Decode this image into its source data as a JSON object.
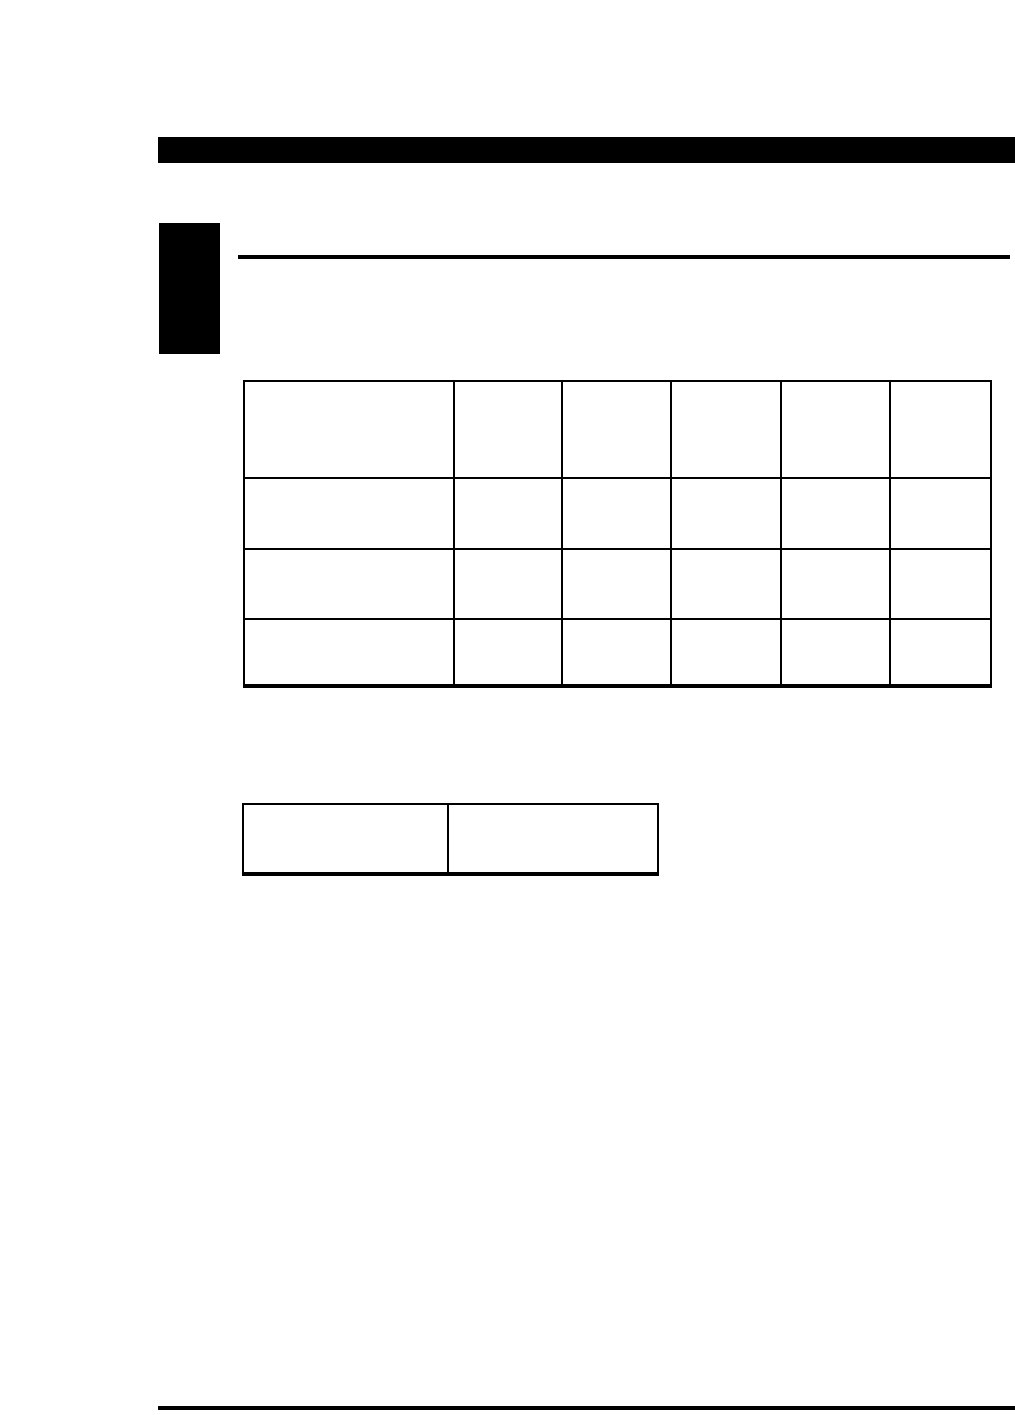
{
  "page": {
    "background_color": "#ffffff",
    "ink_color": "#000000"
  },
  "decorations": {
    "top_bar_color": "#000000",
    "chapter_tab_color": "#000000",
    "header_rule_color": "#000000",
    "footer_rule_color": "#000000"
  },
  "main_table": {
    "rows": [
      [
        "",
        "",
        "",
        "",
        "",
        ""
      ],
      [
        "",
        "",
        "",
        "",
        "",
        ""
      ],
      [
        "",
        "",
        "",
        "",
        "",
        ""
      ],
      [
        "",
        "",
        "",
        "",
        "",
        ""
      ],
      [
        "",
        "",
        "",
        "",
        "",
        ""
      ]
    ]
  },
  "secondary_table": {
    "rows": [
      [
        "",
        ""
      ],
      [
        "",
        ""
      ]
    ]
  }
}
